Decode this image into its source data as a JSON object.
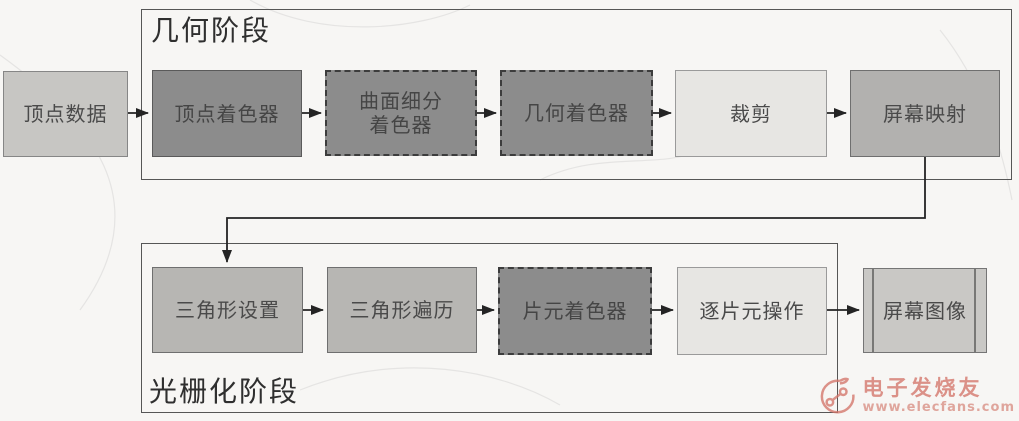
{
  "diagram": {
    "title_context": "rendering-pipeline-flowchart",
    "stages": [
      {
        "id": "geometry",
        "label": "几何阶段"
      },
      {
        "id": "rasterization",
        "label": "光栅化阶段"
      }
    ],
    "nodes": {
      "vertex_data": {
        "label": "顶点数据",
        "style": "light-gray",
        "border": "solid"
      },
      "vertex_shader": {
        "label": "顶点着色器",
        "style": "dark-gray",
        "border": "solid"
      },
      "tessellation_shader": {
        "label": "曲面细分着色器",
        "style": "dark-gray",
        "border": "dashed"
      },
      "geometry_shader": {
        "label": "几何着色器",
        "style": "dark-gray",
        "border": "dashed"
      },
      "clipping": {
        "label": "裁剪",
        "style": "pale-gray",
        "border": "solid"
      },
      "screen_mapping": {
        "label": "屏幕映射",
        "style": "mid-gray",
        "border": "solid"
      },
      "triangle_setup": {
        "label": "三角形设置",
        "style": "mid-gray",
        "border": "solid"
      },
      "triangle_traversal": {
        "label": "三角形遍历",
        "style": "mid-gray",
        "border": "solid"
      },
      "fragment_shader": {
        "label": "片元着色器",
        "style": "dark-gray",
        "border": "dashed"
      },
      "per_fragment_ops": {
        "label": "逐片元操作",
        "style": "pale-gray",
        "border": "solid"
      },
      "screen_image": {
        "label": "屏幕图像",
        "style": "light-gray",
        "border": "double-ruled"
      }
    }
  },
  "watermark": {
    "brand": "电子发烧友",
    "url": "www.elecfans.com",
    "color": "#d4756a"
  },
  "colors": {
    "background": "#f7f6f4",
    "box_dark": "#8c8c8c",
    "box_medium": "#b7b6b3",
    "box_pale": "#e7e6e3",
    "box_light": "#c8c7c4",
    "frame_border": "#565656",
    "arrow": "#242424",
    "text": "#4a4a4a"
  }
}
